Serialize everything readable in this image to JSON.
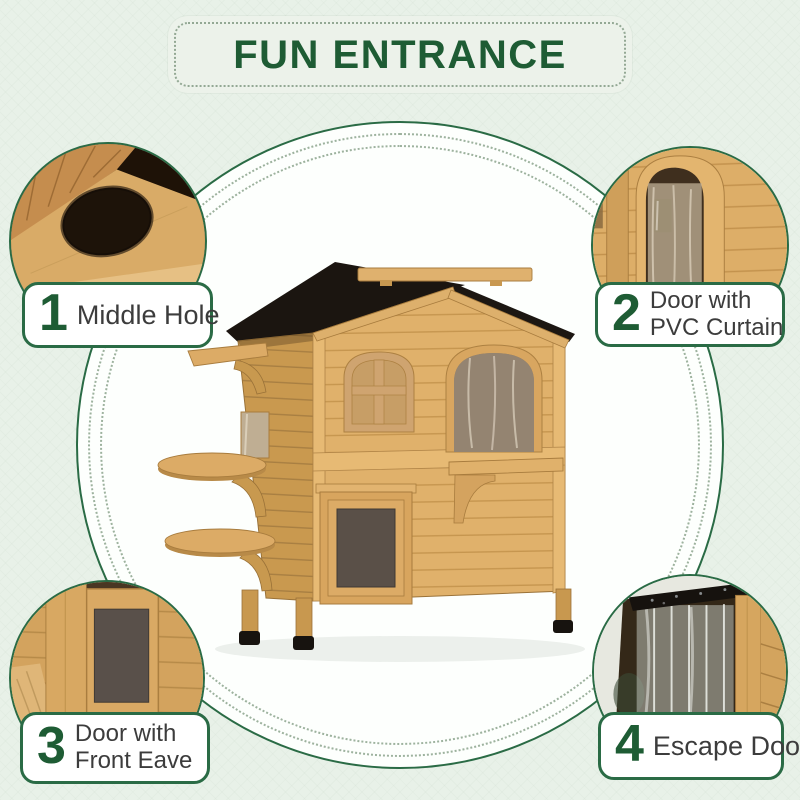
{
  "banner": {
    "title": "FUN ENTRANCE"
  },
  "callouts": [
    {
      "num": "1",
      "line1": "Middle Hole",
      "line2": "",
      "position": "top-left",
      "detail": "middle-hole"
    },
    {
      "num": "2",
      "line1": "Door with",
      "line2": "PVC Curtain",
      "position": "top-right",
      "detail": "door-with-pvc-curtain"
    },
    {
      "num": "3",
      "line1": "Door with",
      "line2": "Front Eave",
      "position": "bottom-left",
      "detail": "door-with-front-eave"
    },
    {
      "num": "4",
      "line1": "Escape Door",
      "line2": "",
      "position": "bottom-right",
      "detail": "escape-door"
    }
  ],
  "colors": {
    "background": "#e8f1e8",
    "banner_fill": "#ecf2ea",
    "accent_green": "#1e5c34",
    "border_green": "#2a6b45",
    "dotted_ring": "#9db29e",
    "label_text": "#3c3c3c",
    "wood": "#dcab66",
    "roof_black": "#1c1712"
  }
}
